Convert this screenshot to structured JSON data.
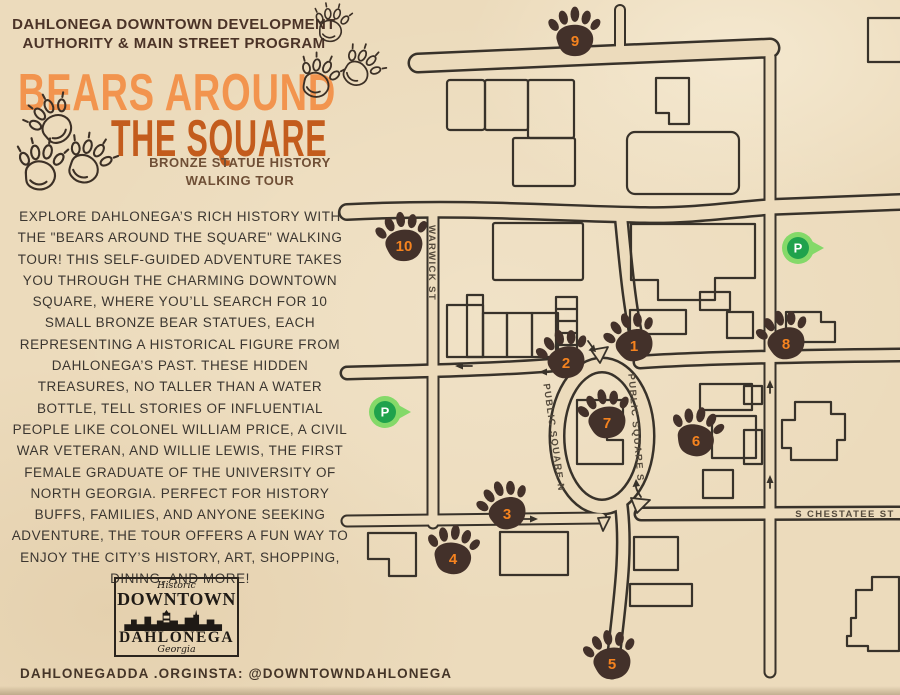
{
  "header": {
    "line1": "DAHLONEGA DOWNTOWN DEVELOPMENT",
    "line2": "AUTHORITY & MAIN STREET PROGRAM"
  },
  "title": {
    "line1": "BEARS AROUND",
    "line2": "THE SQUARE",
    "color1": "#f2944e",
    "color2": "#c35c1d"
  },
  "subtitle": {
    "line1": "BRONZE STATUE HISTORY",
    "line2": "WALKING TOUR"
  },
  "description": "EXPLORE DAHLONEGA’S RICH HISTORY WITH THE \"BEARS AROUND THE SQUARE\" WALKING TOUR! THIS SELF-GUIDED ADVENTURE TAKES YOU THROUGH THE CHARMING DOWNTOWN SQUARE, WHERE YOU’LL SEARCH FOR 10 SMALL BRONZE BEAR STATUES, EACH REPRESENTING A HISTORICAL FIGURE FROM DAHLONEGA’S PAST. THESE HIDDEN TREASURES, NO TALLER THAN A WATER BOTTLE, TELL STORIES OF INFLUENTIAL PEOPLE LIKE COLONEL WILLIAM PRICE, A CIVIL WAR VETERAN, AND WILLIE LEWIS, THE FIRST FEMALE GRADUATE OF THE UNIVERSITY OF NORTH GEORGIA. PERFECT FOR HISTORY BUFFS, FAMILIES, AND ANYONE SEEKING ADVENTURE, THE TOUR OFFERS A FUN WAY TO ENJOY THE CITY’S HISTORY, ART, SHOPPING, DINING, AND MORE!",
  "logo": {
    "script_top": "Historic",
    "line1": "DOWNTOWN",
    "line2": "DAHLONEGA",
    "script_bottom": "Georgia"
  },
  "footer": {
    "website": "DAHLONEGADDA .ORG",
    "instagram": "INSTA: @DOWNTOWNDAHLONEGA"
  },
  "map": {
    "colors": {
      "paw": "#43312a",
      "paw_number": "#f5831f",
      "ink": "#38322a",
      "label": "#544a3c",
      "pin_body": "#84d969",
      "pin_inner": "#1fa24c",
      "pin_letter": "#ffffff"
    },
    "street_labels": [
      {
        "text": "WARWICK ST",
        "x": 429,
        "y": 263,
        "rotate": 90
      },
      {
        "text": "PUBLIC SQUARE N",
        "x": 551,
        "y": 438,
        "rotate": 82
      },
      {
        "text": "PUBLIC SQUARE S",
        "x": 633,
        "y": 428,
        "rotate": 85
      },
      {
        "text": "S CHESTATEE ST",
        "x": 845,
        "y": 517,
        "rotate": 0
      }
    ],
    "markers": [
      {
        "number": "1",
        "x": 634,
        "y": 343,
        "rotate": -18
      },
      {
        "number": "2",
        "x": 566,
        "y": 360,
        "rotate": -14
      },
      {
        "number": "3",
        "x": 507,
        "y": 511,
        "rotate": -18
      },
      {
        "number": "4",
        "x": 453,
        "y": 556,
        "rotate": 8
      },
      {
        "number": "5",
        "x": 612,
        "y": 661,
        "rotate": -8
      },
      {
        "number": "6",
        "x": 696,
        "y": 438,
        "rotate": 14
      },
      {
        "number": "7",
        "x": 607,
        "y": 420,
        "rotate": -10
      },
      {
        "number": "8",
        "x": 786,
        "y": 341,
        "rotate": -14
      },
      {
        "number": "9",
        "x": 575,
        "y": 38,
        "rotate": 2
      },
      {
        "number": "10",
        "x": 404,
        "y": 243,
        "rotate": -6
      }
    ],
    "parking_pins": [
      {
        "label": "P",
        "x": 385,
        "y": 412
      },
      {
        "label": "P",
        "x": 798,
        "y": 248
      }
    ]
  }
}
